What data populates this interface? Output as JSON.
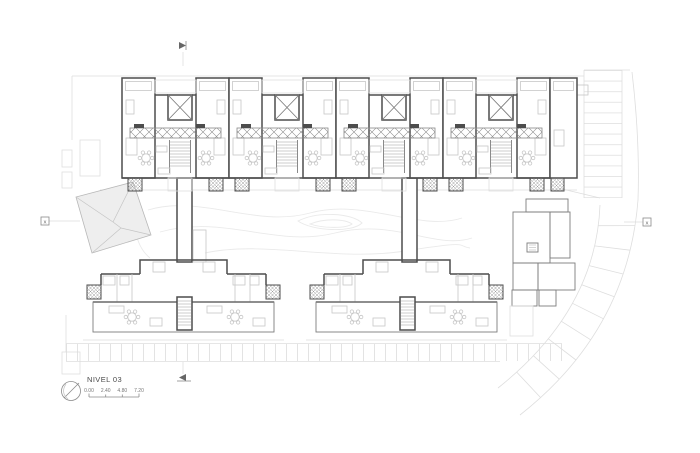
{
  "drawing": {
    "title": "NIVEL 03",
    "scale_labels": [
      "0.00",
      "2.40",
      "4.80",
      "7.20"
    ],
    "section_markers": {
      "left": "X",
      "right": "X"
    },
    "colors": {
      "background": "#ffffff",
      "wall": "#4d4d4d",
      "partition": "#7d7d7d",
      "furniture": "#c7c7c7",
      "site_faint": "#dedede",
      "contour": "#eaeaea",
      "roof_fill": "#eeeeee"
    }
  }
}
